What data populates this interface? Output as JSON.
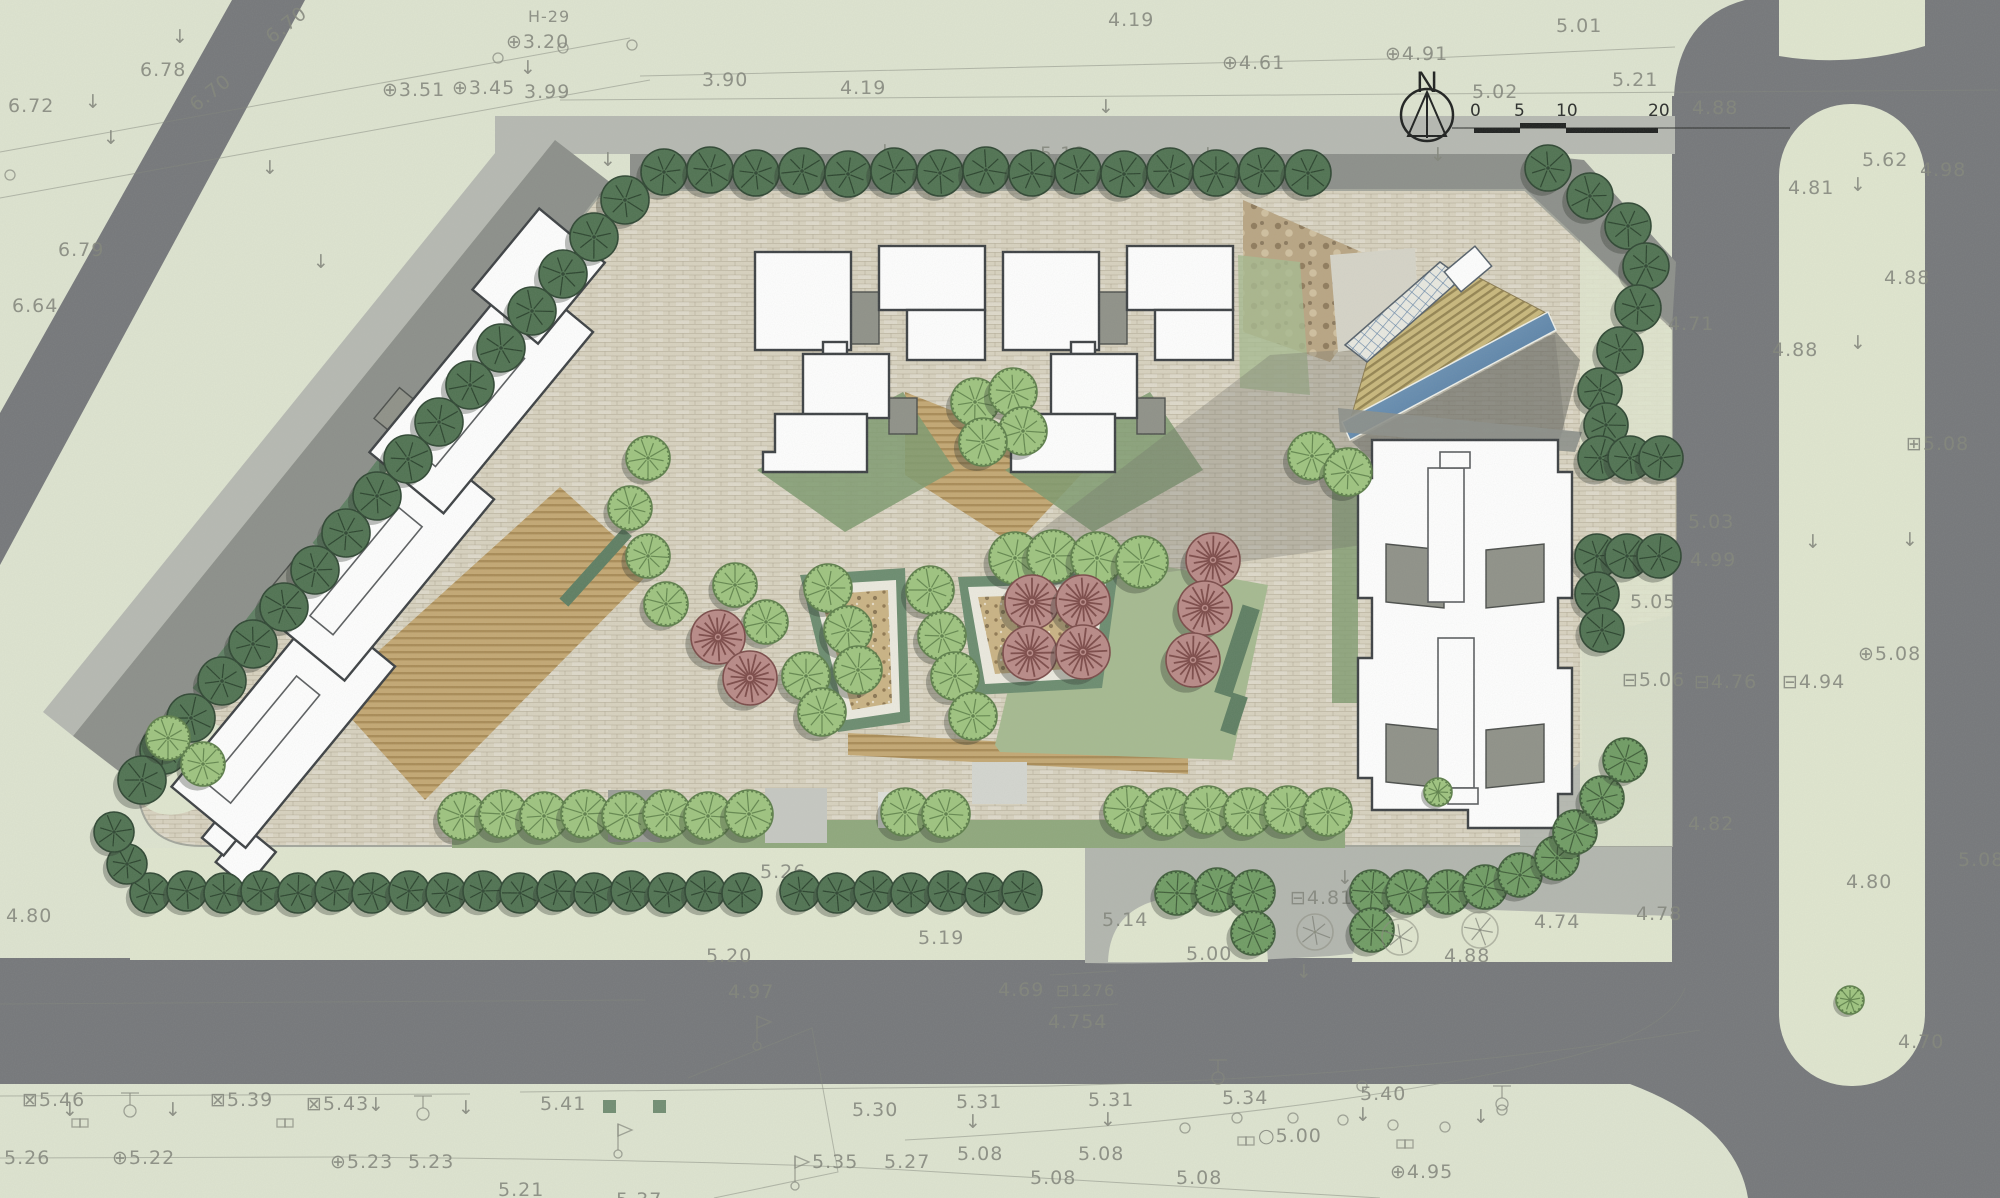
{
  "north": {
    "label": "N"
  },
  "scale_bar": {
    "ticks": [
      "0",
      "5",
      "10",
      "20"
    ]
  },
  "colors": {
    "paper": "#dee4d0",
    "road": "#75777a",
    "sidewalk": "#b6b9b2",
    "plaza": "#b3b6af",
    "shadow_band": "#8c8f8a",
    "pavement": "#d8d2bf",
    "tan": "#c4a873",
    "lawn": "#a6ba90",
    "lawn_dark": "#7e9a6e",
    "grass_verge": "#e0e6cf",
    "planter_frame": "#6b8c6f",
    "planter_fill": "#cab384",
    "building_fill": "#ffffff",
    "building_stroke": "#3c4043",
    "core": "#8f9188",
    "water": "#4f7da7",
    "deck": "#c9b87c",
    "ink": "#82857b",
    "tree_dark": "#4f7251",
    "tree_medium": "#6f9c63",
    "tree_light": "#9ec47f",
    "tree_pink": "#b98a87"
  },
  "elevation_labels": [
    {
      "t": "6.72",
      "x": 8,
      "y": 98
    },
    {
      "t": "6.78",
      "x": 140,
      "y": 62
    },
    {
      "t": "6.70",
      "x": 272,
      "y": 30,
      "rot": -38
    },
    {
      "t": "6.70",
      "x": 196,
      "y": 98,
      "rot": -38
    },
    {
      "t": "6.79",
      "x": 58,
      "y": 242
    },
    {
      "t": "6.64",
      "x": 12,
      "y": 298
    },
    {
      "t": "3.51",
      "x": 382,
      "y": 82,
      "s": "⊕"
    },
    {
      "t": "3.20",
      "x": 506,
      "y": 34,
      "s": "⊕"
    },
    {
      "t": "3.45",
      "x": 452,
      "y": 80,
      "s": "⊕"
    },
    {
      "t": "3.99",
      "x": 524,
      "y": 84
    },
    {
      "t": "3.90",
      "x": 702,
      "y": 72
    },
    {
      "t": "4.19",
      "x": 840,
      "y": 80
    },
    {
      "t": "4.19",
      "x": 1108,
      "y": 12
    },
    {
      "t": "H-29",
      "x": 528,
      "y": 8,
      "fs": 16
    },
    {
      "t": "4.61",
      "x": 1222,
      "y": 55,
      "s": "⊕"
    },
    {
      "t": "4.91",
      "x": 1385,
      "y": 46,
      "s": "⊕"
    },
    {
      "t": "5.01",
      "x": 1556,
      "y": 18
    },
    {
      "t": "5.02",
      "x": 1472,
      "y": 84
    },
    {
      "t": "5.21",
      "x": 1612,
      "y": 72
    },
    {
      "t": "4.88",
      "x": 1692,
      "y": 100
    },
    {
      "t": "5.19",
      "x": 1040,
      "y": 146
    },
    {
      "t": "4.81",
      "x": 748,
      "y": 172,
      "fs": 16
    },
    {
      "t": "4.80",
      "x": 796,
      "y": 174,
      "fs": 16
    },
    {
      "t": "4.96",
      "x": 1018,
      "y": 170,
      "fs": 16
    },
    {
      "t": "5.62",
      "x": 1862,
      "y": 152
    },
    {
      "t": "4.98",
      "x": 1920,
      "y": 162
    },
    {
      "t": "4.81",
      "x": 1788,
      "y": 180
    },
    {
      "t": "4.88",
      "x": 1772,
      "y": 342
    },
    {
      "t": "4.88",
      "x": 1884,
      "y": 270
    },
    {
      "t": "4.71",
      "x": 1668,
      "y": 316
    },
    {
      "t": "5.03",
      "x": 1688,
      "y": 514
    },
    {
      "t": "4.99",
      "x": 1690,
      "y": 552
    },
    {
      "t": "5.05",
      "x": 1630,
      "y": 594
    },
    {
      "t": "5.06",
      "x": 1622,
      "y": 672,
      "s": "⊟"
    },
    {
      "t": "4.76",
      "x": 1694,
      "y": 674,
      "s": "⊟"
    },
    {
      "t": "4.94",
      "x": 1782,
      "y": 674,
      "s": "⊟"
    },
    {
      "t": "5.08",
      "x": 1858,
      "y": 646,
      "s": "⊕"
    },
    {
      "t": "5.08",
      "x": 1906,
      "y": 436,
      "s": "⊞"
    },
    {
      "t": "4.82",
      "x": 1688,
      "y": 816
    },
    {
      "t": "4.80",
      "x": 1846,
      "y": 874
    },
    {
      "t": "5.08",
      "x": 1958,
      "y": 852
    },
    {
      "t": "4.78",
      "x": 1636,
      "y": 906
    },
    {
      "t": "4.74",
      "x": 1534,
      "y": 914
    },
    {
      "t": "4.88",
      "x": 1444,
      "y": 948
    },
    {
      "t": "4.81",
      "x": 1290,
      "y": 890,
      "s": "⊟"
    },
    {
      "t": "5.14",
      "x": 1102,
      "y": 912
    },
    {
      "t": "5.00",
      "x": 1186,
      "y": 946
    },
    {
      "t": "5.26",
      "x": 760,
      "y": 864
    },
    {
      "t": "5.20",
      "x": 706,
      "y": 948
    },
    {
      "t": "5.19",
      "x": 918,
      "y": 930
    },
    {
      "t": "4.97",
      "x": 728,
      "y": 984
    },
    {
      "t": "4.69",
      "x": 998,
      "y": 982
    },
    {
      "t": "4.754",
      "x": 1048,
      "y": 1014
    },
    {
      "t": "1276",
      "x": 1056,
      "y": 982,
      "fs": 16,
      "s": "⊟"
    },
    {
      "t": "4.80",
      "x": 6,
      "y": 908
    },
    {
      "t": "5.46",
      "x": 22,
      "y": 1092,
      "s": "⊠"
    },
    {
      "t": "5.39",
      "x": 210,
      "y": 1092,
      "s": "⊠"
    },
    {
      "t": "5.43",
      "x": 306,
      "y": 1096,
      "s": "⊠"
    },
    {
      "t": "5.26",
      "x": 4,
      "y": 1150
    },
    {
      "t": "5.22",
      "x": 112,
      "y": 1150,
      "s": "⊕"
    },
    {
      "t": "5.23",
      "x": 330,
      "y": 1154,
      "s": "⊕"
    },
    {
      "t": "5.23",
      "x": 408,
      "y": 1154
    },
    {
      "t": "5.21",
      "x": 498,
      "y": 1182
    },
    {
      "t": "5.41",
      "x": 540,
      "y": 1096
    },
    {
      "t": "5.37",
      "x": 616,
      "y": 1192
    },
    {
      "t": "5.30",
      "x": 852,
      "y": 1102
    },
    {
      "t": "5.31",
      "x": 956,
      "y": 1094
    },
    {
      "t": "5.31",
      "x": 1088,
      "y": 1092
    },
    {
      "t": "5.34",
      "x": 1222,
      "y": 1090
    },
    {
      "t": "5.40",
      "x": 1360,
      "y": 1086
    },
    {
      "t": "5.35",
      "x": 812,
      "y": 1154
    },
    {
      "t": "5.27",
      "x": 884,
      "y": 1154
    },
    {
      "t": "5.08",
      "x": 957,
      "y": 1146
    },
    {
      "t": "5.08",
      "x": 1030,
      "y": 1170
    },
    {
      "t": "5.08",
      "x": 1078,
      "y": 1146
    },
    {
      "t": "5.00",
      "x": 1258,
      "y": 1128,
      "s": "○"
    },
    {
      "t": "5.08",
      "x": 1176,
      "y": 1170
    },
    {
      "t": "4.95",
      "x": 1390,
      "y": 1164,
      "s": "⊕"
    },
    {
      "t": "4.70",
      "x": 1898,
      "y": 1034
    }
  ],
  "survey_symbols": {
    "arrows": [
      [
        172,
        27
      ],
      [
        85,
        92
      ],
      [
        103,
        128
      ],
      [
        262,
        158
      ],
      [
        313,
        252
      ],
      [
        520,
        58
      ],
      [
        600,
        150
      ],
      [
        710,
        147
      ],
      [
        877,
        142
      ],
      [
        1098,
        97
      ],
      [
        1200,
        145
      ],
      [
        1430,
        145
      ],
      [
        1850,
        175
      ],
      [
        1850,
        333
      ],
      [
        1805,
        532
      ],
      [
        1902,
        530
      ],
      [
        1337,
        868
      ],
      [
        1296,
        962
      ],
      [
        62,
        1100
      ],
      [
        165,
        1100
      ],
      [
        368,
        1095
      ],
      [
        458,
        1098
      ],
      [
        965,
        1112
      ],
      [
        1100,
        1110
      ],
      [
        1355,
        1105
      ],
      [
        1473,
        1107
      ]
    ],
    "lamps": [
      [
        130,
        1093
      ],
      [
        423,
        1096
      ],
      [
        1218,
        1060
      ],
      [
        1502,
        1086
      ]
    ],
    "manholes": [
      [
        72,
        1119
      ],
      [
        277,
        1119
      ],
      [
        1238,
        1137
      ],
      [
        1397,
        1140
      ]
    ],
    "flags": [
      [
        757,
        1042
      ],
      [
        618,
        1150
      ],
      [
        795,
        1182
      ]
    ],
    "circles": [
      [
        563,
        48
      ],
      [
        632,
        45
      ],
      [
        498,
        58
      ],
      [
        10,
        175
      ],
      [
        1185,
        1128
      ],
      [
        1237,
        1118
      ],
      [
        1293,
        1118
      ],
      [
        1343,
        1120
      ],
      [
        1393,
        1125
      ],
      [
        1445,
        1127
      ],
      [
        1502,
        1110
      ],
      [
        1362,
        1086
      ]
    ],
    "green_squares": [
      [
        603,
        1100
      ],
      [
        653,
        1100
      ]
    ]
  },
  "trees": [
    {
      "type": "dark",
      "r": 23,
      "pts": [
        [
          664,
          172
        ],
        [
          710,
          170
        ],
        [
          756,
          173
        ],
        [
          802,
          171
        ],
        [
          848,
          174
        ],
        [
          894,
          171
        ],
        [
          940,
          173
        ],
        [
          986,
          170
        ],
        [
          1032,
          173
        ],
        [
          1078,
          171
        ],
        [
          1124,
          174
        ],
        [
          1170,
          171
        ],
        [
          1216,
          173
        ],
        [
          1262,
          171
        ],
        [
          1308,
          173
        ],
        [
          1548,
          168
        ],
        [
          1590,
          196
        ],
        [
          1628,
          226
        ],
        [
          1646,
          266
        ],
        [
          1638,
          308
        ],
        [
          1620,
          350
        ]
      ]
    },
    {
      "type": "dark",
      "r": 22,
      "pts": [
        [
          1600,
          390
        ],
        [
          1606,
          425
        ],
        [
          1600,
          458
        ],
        [
          1630,
          458
        ],
        [
          1661,
          458
        ],
        [
          1597,
          556
        ],
        [
          1627,
          556
        ],
        [
          1659,
          556
        ],
        [
          1597,
          594
        ],
        [
          1602,
          630
        ]
      ]
    },
    {
      "type": "dark",
      "r": 24,
      "pts": [
        [
          625,
          200
        ],
        [
          594,
          237
        ],
        [
          563,
          274
        ],
        [
          532,
          311
        ],
        [
          501,
          348
        ],
        [
          470,
          385
        ],
        [
          439,
          422
        ],
        [
          408,
          459
        ],
        [
          377,
          496
        ],
        [
          346,
          533
        ],
        [
          315,
          570
        ],
        [
          284,
          607
        ],
        [
          253,
          644
        ],
        [
          222,
          681
        ],
        [
          191,
          718
        ],
        [
          164,
          750
        ],
        [
          142,
          780
        ]
      ]
    },
    {
      "type": "dark",
      "r": 20,
      "pts": [
        [
          150,
          893
        ],
        [
          187,
          891
        ],
        [
          224,
          893
        ],
        [
          261,
          891
        ],
        [
          298,
          893
        ],
        [
          335,
          891
        ],
        [
          372,
          893
        ],
        [
          409,
          891
        ],
        [
          446,
          893
        ],
        [
          483,
          891
        ],
        [
          520,
          893
        ],
        [
          557,
          891
        ],
        [
          594,
          893
        ],
        [
          631,
          891
        ],
        [
          668,
          893
        ],
        [
          705,
          891
        ],
        [
          742,
          893
        ],
        [
          800,
          891
        ],
        [
          837,
          893
        ],
        [
          874,
          891
        ],
        [
          911,
          893
        ],
        [
          948,
          891
        ],
        [
          985,
          893
        ],
        [
          1022,
          891
        ],
        [
          127,
          864
        ],
        [
          114,
          832
        ]
      ]
    },
    {
      "type": "medium",
      "r": 22,
      "pts": [
        [
          1177,
          893
        ],
        [
          1217,
          890
        ],
        [
          1253,
          892
        ],
        [
          1253,
          933
        ],
        [
          1372,
          892
        ],
        [
          1408,
          892
        ],
        [
          1448,
          892
        ],
        [
          1485,
          887
        ],
        [
          1520,
          875
        ],
        [
          1557,
          858
        ],
        [
          1372,
          930
        ],
        [
          1575,
          832
        ],
        [
          1602,
          798
        ],
        [
          1625,
          760
        ]
      ]
    },
    {
      "type": "light",
      "r": 24,
      "pts": [
        [
          462,
          816
        ],
        [
          503,
          814
        ],
        [
          544,
          816
        ],
        [
          585,
          814
        ],
        [
          626,
          816
        ],
        [
          667,
          814
        ],
        [
          708,
          816
        ],
        [
          749,
          814
        ],
        [
          905,
          812
        ],
        [
          946,
          814
        ],
        [
          1128,
          810
        ],
        [
          1168,
          812
        ],
        [
          1208,
          810
        ],
        [
          1248,
          812
        ],
        [
          1288,
          810
        ],
        [
          1328,
          812
        ]
      ]
    },
    {
      "type": "light",
      "r": 22,
      "pts": [
        [
          168,
          738
        ],
        [
          203,
          764
        ],
        [
          648,
          458
        ],
        [
          630,
          508
        ],
        [
          648,
          556
        ],
        [
          666,
          604
        ],
        [
          735,
          585
        ],
        [
          766,
          622
        ]
      ]
    },
    {
      "type": "light",
      "r": 26,
      "pts": [
        [
          1015,
          558
        ],
        [
          1053,
          556
        ],
        [
          1097,
          558
        ],
        [
          1142,
          562
        ]
      ]
    },
    {
      "type": "light",
      "r": 24,
      "pts": [
        [
          828,
          588
        ],
        [
          848,
          630
        ],
        [
          858,
          670
        ],
        [
          806,
          676
        ],
        [
          822,
          712
        ],
        [
          930,
          590
        ],
        [
          942,
          636
        ],
        [
          955,
          676
        ],
        [
          973,
          716
        ],
        [
          975,
          402
        ],
        [
          1013,
          392
        ],
        [
          1023,
          431
        ],
        [
          983,
          442
        ],
        [
          1312,
          456
        ],
        [
          1348,
          472
        ]
      ]
    },
    {
      "type": "light",
      "r": 14,
      "pts": [
        [
          1438,
          792
        ],
        [
          1850,
          1000
        ]
      ]
    },
    {
      "type": "pink",
      "r": 27,
      "pts": [
        [
          718,
          637
        ],
        [
          750,
          678
        ],
        [
          1032,
          602
        ],
        [
          1083,
          602
        ],
        [
          1030,
          653
        ],
        [
          1083,
          652
        ],
        [
          1213,
          560
        ],
        [
          1205,
          608
        ],
        [
          1193,
          660
        ]
      ]
    },
    {
      "type": "sketch",
      "r": 18,
      "pts": [
        [
          1315,
          932
        ],
        [
          1400,
          937
        ],
        [
          1480,
          930
        ]
      ]
    }
  ]
}
